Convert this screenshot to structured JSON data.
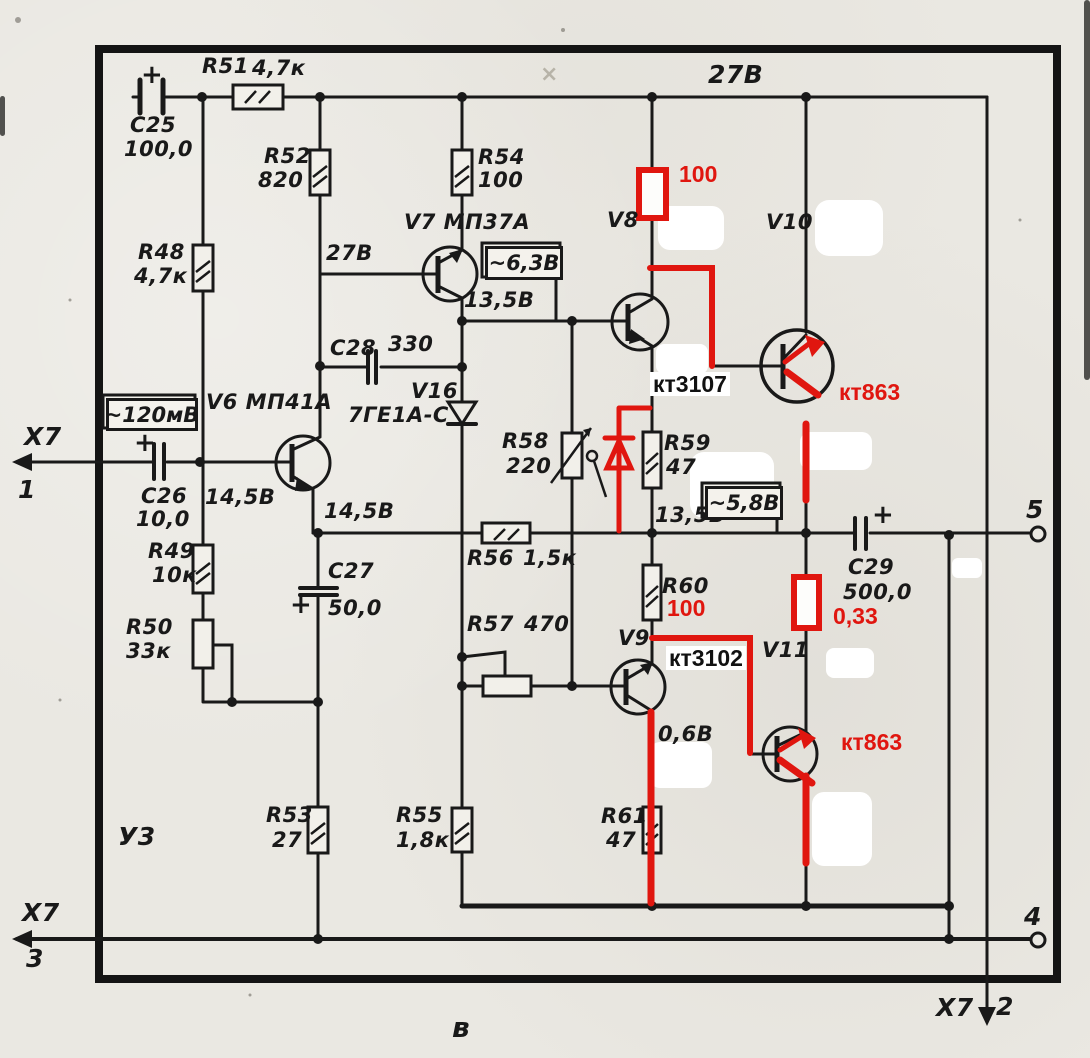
{
  "connector": {
    "name": "X7",
    "pin1": "1",
    "pin2": "2",
    "pin3": "3",
    "pin4": "4",
    "pin5": "5"
  },
  "module_label": "У3",
  "section_label": "в",
  "supply_rail_voltage": "27В",
  "colors": {
    "paper": "#eae8e2",
    "ink": "#191919",
    "annotation_red": "#e0160f",
    "whiteout": "#ffffff"
  },
  "components": {
    "c25": {
      "ref": "C25",
      "value": "100,0",
      "plus": "+"
    },
    "r51": {
      "ref": "R51",
      "value": "4,7к"
    },
    "r48": {
      "ref": "R48",
      "value": "4,7к"
    },
    "r52": {
      "ref": "R52",
      "value": "820"
    },
    "r54": {
      "ref": "R54",
      "value": "100"
    },
    "v7": {
      "ref": "V7 МП37А",
      "collector_voltage": "27В",
      "emitter_voltage": "13,5В"
    },
    "c28": {
      "ref": "C28",
      "value": "330"
    },
    "v16": {
      "ref": "V16",
      "value": "7ГЕ1А-С"
    },
    "v6": {
      "ref": "V6 МП41А",
      "base_voltage": "14,5В",
      "emitter_voltage": "14,5В"
    },
    "c26": {
      "ref": "C26",
      "value": "10,0",
      "plus": "+"
    },
    "r49": {
      "ref": "R49",
      "value": "10к"
    },
    "r50": {
      "ref": "R50",
      "value": "33к"
    },
    "c27": {
      "ref": "C27",
      "value": "50,0",
      "plus": "+"
    },
    "r53": {
      "ref": "R53",
      "value": "27"
    },
    "r55": {
      "ref": "R55",
      "value": "1,8к"
    },
    "r56": {
      "ref": "R56",
      "value": "1,5к"
    },
    "r57": {
      "ref": "R57",
      "value": "470"
    },
    "r58": {
      "ref": "R58",
      "value": "220"
    },
    "r59": {
      "ref": "R59",
      "value": "47"
    },
    "r60": {
      "ref": "R60"
    },
    "r61": {
      "ref": "R61",
      "value": "47"
    },
    "c29": {
      "ref": "C29",
      "value": "500,0",
      "plus": "+"
    },
    "v8": {
      "ref": "V8"
    },
    "v9": {
      "ref": "V9",
      "be_voltage": "0,6В"
    },
    "v10": {
      "ref": "V10"
    },
    "v11": {
      "ref": "V11"
    }
  },
  "measurement_boxes": {
    "input": "~120мВ",
    "driver": "~6,3В",
    "output": "~5,8В"
  },
  "mid_rail_voltage": "13,5В",
  "red_annotations": {
    "v8_emitter_resistor": "100",
    "r60_new_value": "100",
    "output_resistor": "0,33",
    "v10_type": "кт863",
    "v11_type": "кт863"
  },
  "typed_annotations": {
    "v8_type": "кт3107",
    "v9_type": "кт3102"
  }
}
